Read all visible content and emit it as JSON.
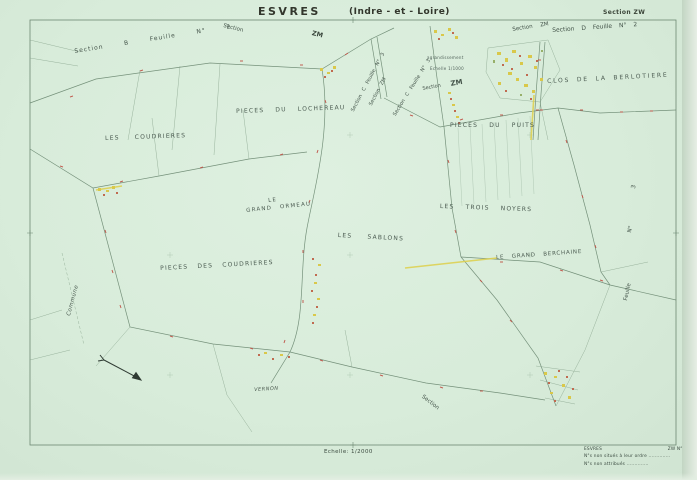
{
  "palette": {
    "paper": "#d8ecda",
    "linework": "#7d9a82",
    "boundary_red": "#bf4f43",
    "road_yellow": "#ddd052",
    "text": "#44544a"
  },
  "header": {
    "commune": "ESVRES",
    "department": "(Indre - et - Loire)",
    "section": "Section ZW"
  },
  "border_labels": {
    "section_b_feuille_2": "Section B Feuille N° 2",
    "section_top": "Section",
    "zm_top": "ZM",
    "section_c_feuille_3_a": "Section C Feuille N° 3",
    "section_zm_a": "Section ZM",
    "section_c_feuille_3_b": "Section C Feuille N° 3",
    "section_mid": "Section",
    "zm_big": "ZM",
    "enlargement_note_1": "agrandissement",
    "enlargement_note_2": "Echelle 1/1000",
    "section_zm_top_right": "Section ZM",
    "section_d_feuille_2": "Section D Feuille N° 2"
  },
  "place_names": {
    "clos_de_la_berlotiere": "CLOS DE LA BERLOTIERE",
    "pieces_du_lochereau": "PIECES DU LOCHEREAU",
    "les_coudrieres": "LES COUDRIERES",
    "pieces_du_puits": "PIECES DU PUITS",
    "le_grand_ormeau_line1": "LE",
    "le_grand_ormeau_line2": "GRAND ORMEAU",
    "les_trois_noyers": "LES TROIS NOYERS",
    "les_sablons": "LES SABLONS",
    "le_grand_berchaine": "LE GRAND BERCHAINE",
    "pieces_des_coudrieres": "PIECES DES COUDRIERES",
    "vernon": "VERNON"
  },
  "edge_labels": {
    "commune": "Commune",
    "feuille": "Feuille",
    "numero": "N°",
    "three": "3",
    "section_bottom": "Section"
  },
  "footer": {
    "scale": "Echelle: 1/2000",
    "legend_commune": "ESVRES",
    "legend_section": "ZW  N°s  1 à",
    "legend_line2": "N°s non situés à leur ordre ..............",
    "legend_line3": "N°s non attribués .............."
  }
}
